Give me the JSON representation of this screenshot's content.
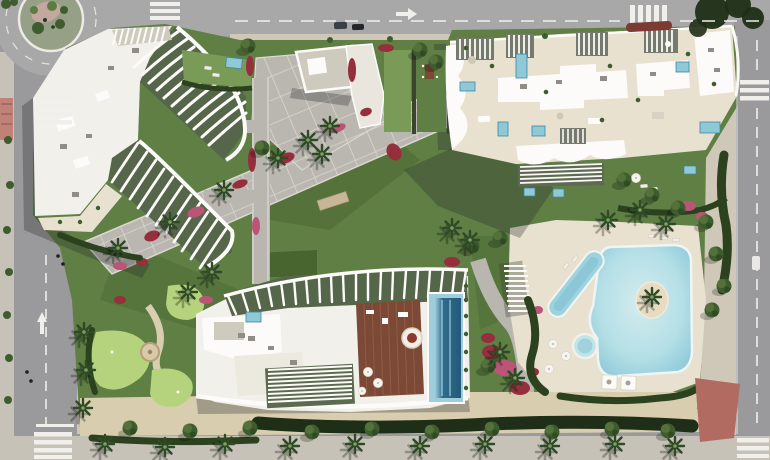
{
  "scene": {
    "type": "aerial-architectural-render",
    "description": "Aerial top-down 3D render of a residential development: three white apartment buildings with sculpted curved balconies arranged around landscaped gardens, a freeform lagoon pool with a palm island, a lap pool and round jacuzzi, a rooftop infinity pool with timber sun deck, a putting green, diagonal paved promenades, a planted roundabout and surrounding streets with zebra crossings.",
    "areas": {
      "roundabout": {
        "label": "roundabout with planted island"
      },
      "streets": {
        "west_street": "two-lane street with dashed centre line, lane arrow and two zebra crossings",
        "north_avenue": "avenue with dashed lane line, direction arrow, zebra crossing and red median island",
        "east_street": "street with dashed lane line and two zebra crossings",
        "vehicles": "two dark cars on the avenue, one white car on the east street"
      },
      "buildings": {
        "northwest": {
          "label": "apartment block with fans of curved white balcony fins",
          "features": [
            "rooftop slat pergola",
            "AC units",
            "planted terraces",
            "garden with plunge pool"
          ]
        },
        "northeast": {
          "label": "apartment block with sand-coloured roof terraces",
          "features": [
            "slatted pergolas",
            "private plunge pools",
            "white roof slabs",
            "scalloped balcony edges"
          ]
        },
        "south": {
          "label": "apartment block with rooftop amenities",
          "features": [
            "dark-blue rooftop pool",
            "timber sun deck",
            "circular lounge with parasol",
            "radiating roof fins",
            "slat pergolas",
            "white umbrellas"
          ]
        }
      },
      "amenities": {
        "main_pool": "freeform lagoon pool with central palm island",
        "lap_pool": "diagonal lap pool",
        "jacuzzi": "round spa pool",
        "cabanas": "two white day-bed cabanas at the pool edge",
        "putting_green": "mini-golf putting green with circular feature and winding path",
        "promenade": "diagonal grid-paved promenade crossing the gardens",
        "pavilion": "gravel-roof pavilion and white community building by the plaza"
      },
      "landscape": {
        "palms": "palm trees with star-shaped crowns casting shadows",
        "hedges": "dark clipped hedges bordering pool deck and boundary",
        "flowers": "crimson and pink bougainvillea beds along the paths",
        "boundary": "dense dark hedge band and sandy walk along the south edge"
      }
    }
  },
  "palette": {
    "asphalt": "#9a999b",
    "asphaltLight": "#a9a8a9",
    "sidewalk": "#c6c2b8",
    "sidewalkWarm": "#cfc8b8",
    "roadWhite": "#f0efeb",
    "redPaving": "#b26b60",
    "pinkBuilding": "#c08177",
    "lawn": "#5f7f44",
    "lawnLight": "#7a9a58",
    "lawnDark": "#49652f",
    "putting": "#b5d37c",
    "pavement": "#b9b6af",
    "pavementLight": "#c6c3bc",
    "deck": "#e8e1cf",
    "sand": "#d9cdb0",
    "roofWhite": "#f2f0ea",
    "pureWhite": "#fcfbf9",
    "roofGravel": "#cfcabe",
    "woodDeck": "#7c4936",
    "woodLight": "#96604b",
    "finGreen": "#55664a",
    "poolLight": "#c4e4e9",
    "poolMid": "#8fc9d6",
    "poolDark": "#276586",
    "poolRim": "#3f87a6",
    "hedge": "#2c421f",
    "hedgeDark": "#1f2e16",
    "tree": "#3e5c2e",
    "treeLight": "#5d7c42",
    "palm": "#2e4a26",
    "flowerRed": "#962f3d",
    "flowerPink": "#bb5577"
  }
}
